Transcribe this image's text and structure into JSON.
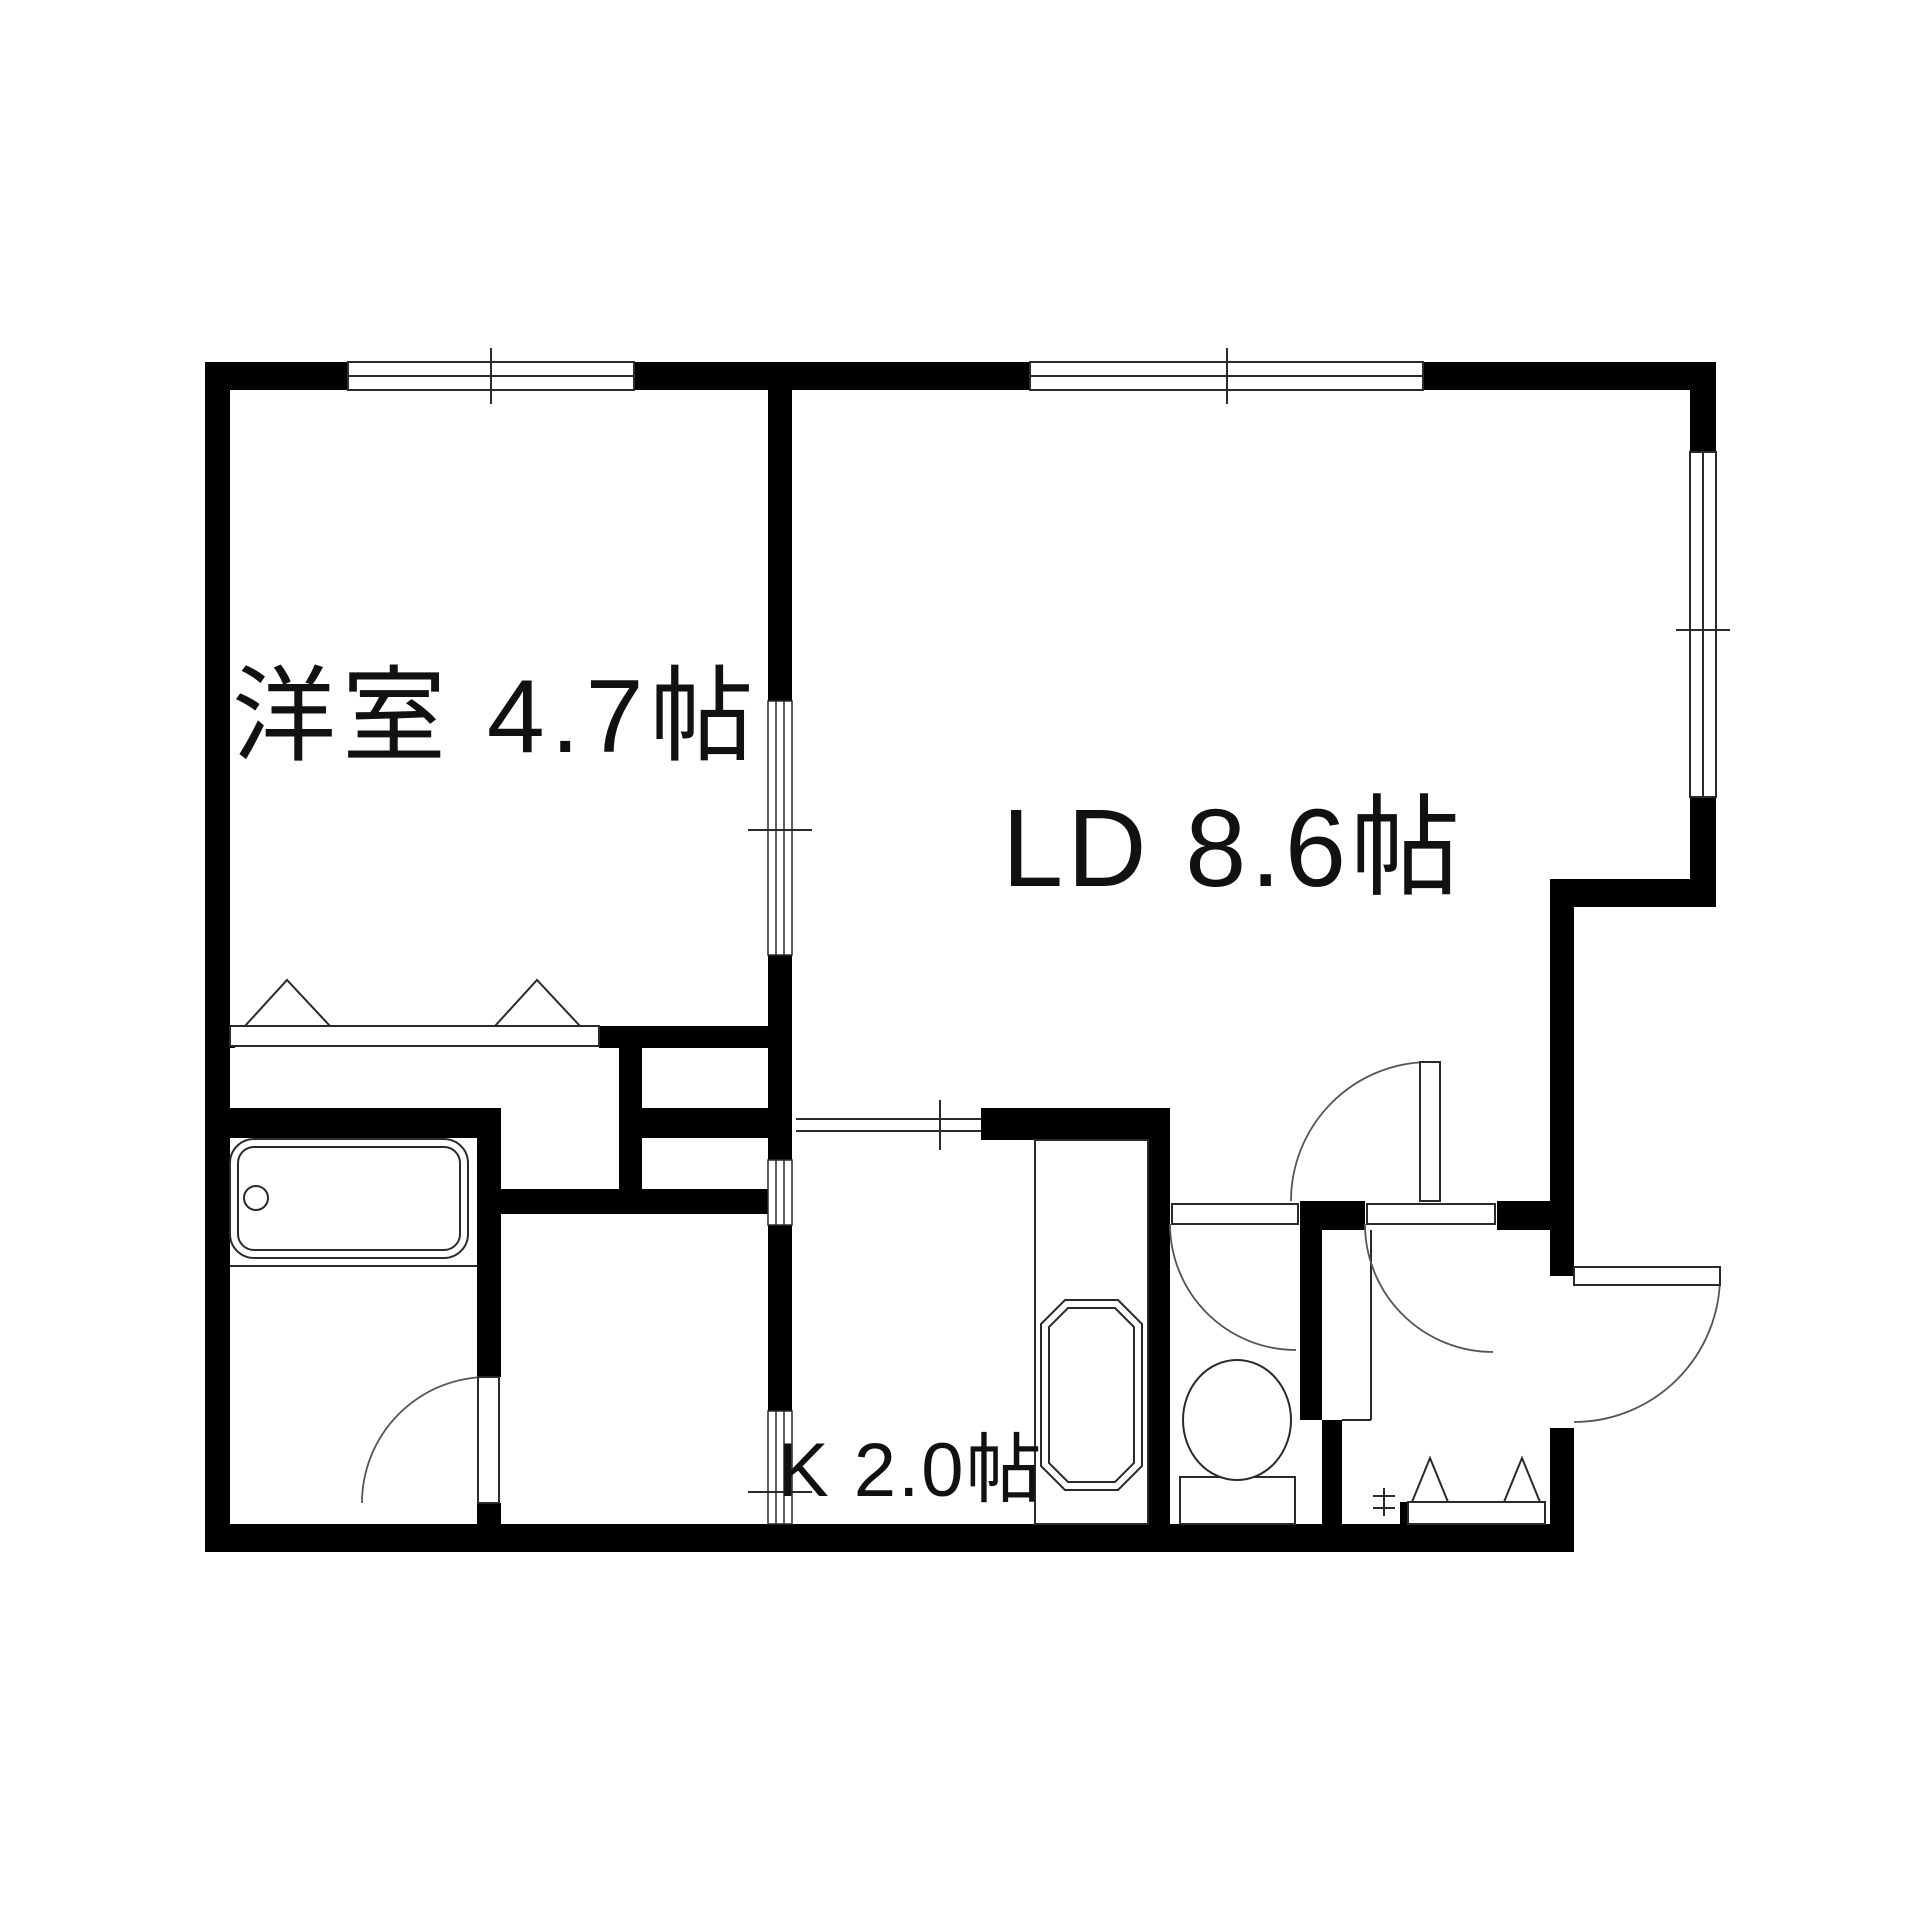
{
  "page": {
    "background": "#ffffff",
    "kind": "apartment-floor-plan"
  },
  "floor_plan": {
    "canvas": {
      "width": 1920,
      "height": 1920
    },
    "colors": {
      "wall": "#000000",
      "bg": "#ffffff",
      "line": "#2a2a2a",
      "arc": "#555555",
      "text": "#111111"
    },
    "rooms": [
      {
        "name": "western-room",
        "label": "洋室 4.7帖",
        "x": 232,
        "y": 752,
        "font": 104,
        "ls": 6
      },
      {
        "name": "living-dining",
        "label": "LD 8.6帖",
        "x": 1002,
        "y": 886,
        "font": 110,
        "ls": 4
      },
      {
        "name": "kitchen",
        "label": "K 2.0帖",
        "x": 778,
        "y": 1496,
        "font": 76,
        "ls": 2
      }
    ],
    "walls": [
      [
        205,
        362,
        1511,
        28
      ],
      [
        205,
        362,
        25,
        1190
      ],
      [
        205,
        1524,
        1369,
        28
      ],
      [
        1690,
        362,
        26,
        545
      ],
      [
        1550,
        879,
        166,
        28
      ],
      [
        1550,
        879,
        24,
        397
      ],
      [
        1550,
        1428,
        24,
        124
      ],
      [
        768,
        362,
        24,
        339
      ],
      [
        768,
        955,
        24,
        205
      ],
      [
        768,
        1225,
        24,
        186
      ],
      [
        205,
        1026,
        30,
        22
      ],
      [
        599,
        1026,
        193,
        22
      ],
      [
        619,
        1048,
        23,
        141
      ],
      [
        642,
        1108,
        126,
        30
      ],
      [
        205,
        1108,
        296,
        30
      ],
      [
        477,
        1138,
        24,
        76
      ],
      [
        501,
        1189,
        291,
        25
      ],
      [
        477,
        1214,
        24,
        163
      ],
      [
        477,
        1503,
        24,
        49
      ],
      [
        981,
        1108,
        189,
        32
      ],
      [
        1148,
        1108,
        22,
        416
      ],
      [
        1300,
        1201,
        65,
        29
      ],
      [
        1497,
        1201,
        53,
        29
      ],
      [
        1300,
        1201,
        22,
        219
      ],
      [
        1322,
        1420,
        20,
        104
      ],
      [
        1400,
        1502,
        16,
        22
      ]
    ],
    "windows": [
      {
        "x": 348,
        "y": 362,
        "w": 286,
        "h": 28,
        "orient": "h",
        "tick": 491
      },
      {
        "x": 1030,
        "y": 362,
        "w": 393,
        "h": 28,
        "orient": "h",
        "tick": 1227
      },
      {
        "x": 1690,
        "y": 452,
        "w": 26,
        "h": 345,
        "orient": "v",
        "tick": 630
      }
    ],
    "openings": [
      {
        "x": 768,
        "y": 701,
        "w": 24,
        "h": 129,
        "orient": "v"
      },
      {
        "x": 768,
        "y": 830,
        "w": 24,
        "h": 125,
        "orient": "v"
      },
      {
        "x": 768,
        "y": 1160,
        "w": 24,
        "h": 65,
        "orient": "v"
      },
      {
        "x": 768,
        "y": 1411,
        "w": 24,
        "h": 113,
        "orient": "v"
      }
    ],
    "opening_lines": [
      [
        748,
        830,
        812,
        830
      ],
      [
        748,
        1492,
        812,
        1492
      ],
      [
        796,
        1119,
        981,
        1119
      ],
      [
        796,
        1131,
        981,
        1131
      ],
      [
        940,
        1100,
        940,
        1150
      ]
    ],
    "doors": [
      {
        "name": "bath-door",
        "gap": [
          477,
          1377,
          24,
          126
        ],
        "leaf": [
          478,
          1377,
          21,
          126
        ],
        "arc": "M 488 1377 A 126 126 0 0 0 362 1503"
      },
      {
        "name": "toilet-door",
        "gap": [
          1170,
          1201,
          130,
          29
        ],
        "leaf": [
          1172,
          1204,
          126,
          20
        ],
        "arc": "M 1170 1224 A 126 126 0 0 0 1296 1350"
      },
      {
        "name": "entrance-hall-door",
        "gap": [
          1365,
          1201,
          132,
          29
        ],
        "leaf": [
          1367,
          1204,
          128,
          20
        ],
        "arc": "M 1365 1224 A 128 128 0 0 0 1493 1352"
      },
      {
        "name": "ld-corridor-door",
        "gap": null,
        "leaf": [
          1420,
          1062,
          20,
          139
        ],
        "arc": "M 1430 1062 A 139 139 0 0 0 1291 1201"
      },
      {
        "name": "entry-door",
        "gap": [
          1550,
          1276,
          24,
          152
        ],
        "leaf": [
          1574,
          1267,
          146,
          18
        ],
        "arc": "M 1720 1276 A 146 146 0 0 1 1574 1422"
      }
    ],
    "fixtures": [
      {
        "t": "rect",
        "name": "bathtub-outer",
        "v": [
          230,
          1139,
          238,
          119
        ],
        "rx": 24
      },
      {
        "t": "rect",
        "name": "bathtub-inner",
        "v": [
          238,
          1147,
          222,
          103
        ],
        "rx": 16
      },
      {
        "t": "circle",
        "name": "bathtub-faucet",
        "v": [
          256,
          1198,
          12
        ]
      },
      {
        "t": "line",
        "name": "bathtub-ledge",
        "v": [
          230,
          1266,
          477,
          1266
        ]
      },
      {
        "t": "rect",
        "name": "closet-strip",
        "v": [
          230,
          1026,
          369,
          20
        ]
      },
      {
        "t": "poly",
        "name": "closet-door-triangle",
        "v": "245,1026 330,1026 287,980"
      },
      {
        "t": "poly",
        "name": "closet-door-triangle",
        "v": "495,1026 580,1026 537,980"
      },
      {
        "t": "rect",
        "name": "kitchen-counter",
        "v": [
          1035,
          1140,
          113,
          384
        ]
      },
      {
        "t": "path",
        "name": "kitchen-sink-outer",
        "v": "M 1065 1300 L 1118 1300 L 1142 1324 L 1142 1466 L 1118 1490 L 1065 1490 L 1041 1466 L 1041 1324 Z"
      },
      {
        "t": "path",
        "name": "kitchen-sink-inner",
        "v": "M 1068 1308 L 1115 1308 L 1134 1327 L 1134 1463 L 1115 1482 L 1068 1482 L 1049 1463 L 1049 1327 Z"
      },
      {
        "t": "rect",
        "name": "toilet-tank",
        "v": [
          1180,
          1477,
          115,
          47
        ]
      },
      {
        "t": "ellipse",
        "name": "toilet-bowl",
        "v": [
          1237,
          1420,
          54,
          60
        ]
      },
      {
        "t": "rect",
        "name": "shoe-cabinet-strip",
        "v": [
          1408,
          1502,
          137,
          22
        ]
      },
      {
        "t": "poly",
        "name": "shoe-cabinet-triangle",
        "v": "1412,1502 1448,1502 1430,1458"
      },
      {
        "t": "poly",
        "name": "shoe-cabinet-triangle",
        "v": "1504,1502 1540,1502 1522,1458"
      },
      {
        "t": "line",
        "name": "genkan-step",
        "v": [
          1371,
          1230,
          1371,
          1420
        ]
      },
      {
        "t": "line",
        "name": "genkan-step",
        "v": [
          1342,
          1420,
          1371,
          1420
        ]
      },
      {
        "t": "line",
        "name": "meter-box",
        "v": [
          1373,
          1496,
          1395,
          1496
        ]
      },
      {
        "t": "line",
        "name": "meter-box",
        "v": [
          1373,
          1508,
          1395,
          1508
        ]
      },
      {
        "t": "line",
        "name": "meter-box",
        "v": [
          1384,
          1488,
          1384,
          1516
        ]
      }
    ]
  }
}
